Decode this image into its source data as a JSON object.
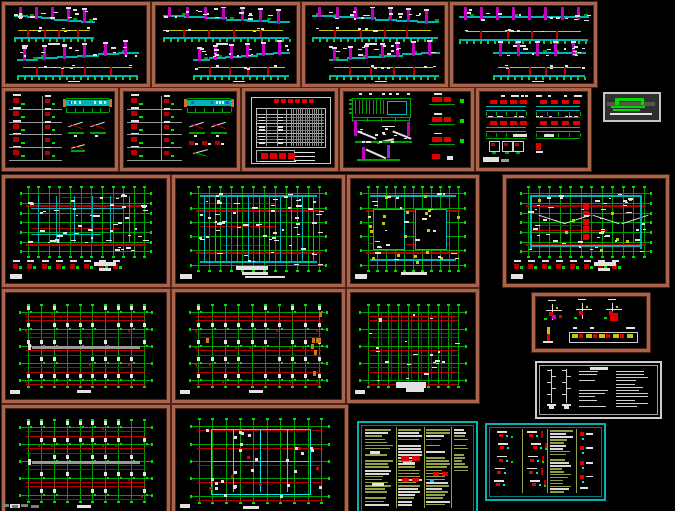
{
  "meta": {
    "title": "cad-structural-drawing-set-montage",
    "canvas": {
      "w": 675,
      "h": 511
    },
    "background": "#000000"
  },
  "palette": {
    "panelBrown": "#a8644c",
    "panelBrownDark": "#4e2416",
    "white": "#e2e2e2",
    "gray": "#9a9a9a",
    "darkGray": "#6f6f6f",
    "green": "#00a000",
    "brightGreen": "#00e000",
    "cyan": "#00b4b4",
    "brightCyan": "#00e8e8",
    "magenta": "#c400c4",
    "purple": "#8a2be2",
    "red": "#b40000",
    "brightRed": "#e00000",
    "yellow": "#c8c800",
    "orange": "#c87820",
    "olive": "#93a048",
    "blue": "#2a4bdd",
    "logoGreen": "#00d800"
  },
  "panels": [
    {
      "name": "sheet-longitudinal-section-1",
      "kind": "elevationPair",
      "x": 2,
      "y": 2,
      "w": 148,
      "h": 85,
      "border": "brown",
      "seed": 11,
      "opts": {
        "bands": [
          {
            "x0": 0.05,
            "x1": 0.63,
            "gy": 0.4,
            "slope": -1,
            "cols": 5
          },
          {
            "x0": 0.07,
            "x1": 0.95,
            "gy": 0.9,
            "slope": 1,
            "cols": 6
          }
        ]
      }
    },
    {
      "name": "sheet-longitudinal-section-2",
      "kind": "elevationPair",
      "x": 152,
      "y": 2,
      "w": 148,
      "h": 85,
      "border": "brown",
      "seed": 12,
      "opts": {
        "bands": [
          {
            "x0": 0.04,
            "x1": 0.96,
            "gy": 0.4,
            "slope": -1,
            "cols": 7
          },
          {
            "x0": 0.26,
            "x1": 0.96,
            "gy": 0.9,
            "slope": 1,
            "cols": 6
          }
        ]
      }
    },
    {
      "name": "sheet-longitudinal-section-3",
      "kind": "elevationPair",
      "x": 302,
      "y": 2,
      "w": 146,
      "h": 85,
      "border": "brown",
      "seed": 13,
      "opts": {
        "bands": [
          {
            "x0": 0.04,
            "x1": 0.96,
            "gy": 0.4,
            "slope": -1,
            "cols": 7
          },
          {
            "x0": 0.16,
            "x1": 0.97,
            "gy": 0.9,
            "slope": 1,
            "cols": 7
          }
        ]
      }
    },
    {
      "name": "sheet-longitudinal-section-4",
      "kind": "elevationPair",
      "x": 450,
      "y": 2,
      "w": 147,
      "h": 85,
      "border": "brown",
      "seed": 14,
      "opts": {
        "bands": [
          {
            "x0": 0.03,
            "x1": 0.97,
            "gy": 0.42,
            "slope": 0,
            "cols": 8
          },
          {
            "x0": 0.28,
            "x1": 0.95,
            "gy": 0.9,
            "slope": 0,
            "cols": 5
          }
        ]
      }
    },
    {
      "name": "sheet-beam-details-1",
      "kind": "detailGrid",
      "x": 2,
      "y": 88,
      "w": 116,
      "h": 83,
      "border": "brown",
      "seed": 21,
      "opts": {}
    },
    {
      "name": "sheet-beam-details-2",
      "kind": "detailGrid",
      "x": 120,
      "y": 88,
      "w": 120,
      "h": 83,
      "border": "brown",
      "seed": 22,
      "opts": {
        "variant": 2
      }
    },
    {
      "name": "sheet-schedule-table",
      "kind": "tableSheet",
      "x": 242,
      "y": 88,
      "w": 96,
      "h": 83,
      "border": "brown",
      "seed": 23,
      "opts": {}
    },
    {
      "name": "sheet-stair-details",
      "kind": "stairSheet",
      "x": 340,
      "y": 88,
      "w": 134,
      "h": 83,
      "border": "brown",
      "seed": 24,
      "opts": {}
    },
    {
      "name": "sheet-section-details",
      "kind": "detailSheet2",
      "x": 476,
      "y": 88,
      "w": 115,
      "h": 83,
      "border": "brown",
      "seed": 25,
      "opts": {}
    },
    {
      "name": "logo-mark",
      "kind": "logo",
      "x": 603,
      "y": 92,
      "w": 58,
      "h": 30,
      "border": "logo",
      "seed": 26,
      "opts": {}
    },
    {
      "name": "sheet-floor-framing-plan-1",
      "kind": "floorPlan",
      "x": 2,
      "y": 175,
      "w": 168,
      "h": 112,
      "border": "brown",
      "seed": 31,
      "opts": {
        "cyan": "mixed",
        "bottomRow": true,
        "nv": 12,
        "nh": 7,
        "specks": 50
      }
    },
    {
      "name": "sheet-floor-framing-plan-2",
      "kind": "floorPlan",
      "x": 172,
      "y": 175,
      "w": 173,
      "h": 112,
      "border": "brown",
      "seed": 32,
      "opts": {
        "cyanDense": true,
        "titleSmudge": "big",
        "nv": 12,
        "nh": 6,
        "specks": 60
      }
    },
    {
      "name": "sheet-roof-plan",
      "kind": "floorPlan",
      "x": 347,
      "y": 175,
      "w": 132,
      "h": 112,
      "border": "brown",
      "seed": 33,
      "opts": {
        "openings": true,
        "yellow": 18,
        "titleSmudge": true,
        "nv": 11,
        "nh": 6,
        "specks": 25
      }
    },
    {
      "name": "sheet-roof-framing-plan",
      "kind": "floorPlan",
      "x": 503,
      "y": 175,
      "w": 166,
      "h": 112,
      "border": "brown",
      "seed": 34,
      "opts": {
        "diagonals": true,
        "yellow": 8,
        "bottomRow": true,
        "nv": 12,
        "nh": 7,
        "specks": 45
      }
    },
    {
      "name": "sheet-column-plan-1",
      "kind": "columnPlan",
      "x": 2,
      "y": 289,
      "w": 168,
      "h": 114,
      "border": "brown",
      "seed": 41,
      "opts": {
        "grayBar": true
      }
    },
    {
      "name": "sheet-column-plan-2",
      "kind": "columnPlan",
      "x": 172,
      "y": 289,
      "w": 173,
      "h": 114,
      "border": "brown",
      "seed": 42,
      "opts": {
        "orange": true
      }
    },
    {
      "name": "sheet-foundation-plan",
      "kind": "foundationPlan",
      "x": 347,
      "y": 289,
      "w": 132,
      "h": 114,
      "border": "brown",
      "seed": 43,
      "opts": {}
    },
    {
      "name": "sheet-column-reinf-details",
      "kind": "smallDetailPanel",
      "x": 532,
      "y": 293,
      "w": 118,
      "h": 59,
      "border": "brown",
      "seed": 44,
      "opts": {}
    },
    {
      "name": "sheet-general-notes-1",
      "kind": "notesWhite",
      "x": 535,
      "y": 361,
      "w": 127,
      "h": 58,
      "border": "white",
      "seed": 45,
      "opts": {}
    },
    {
      "name": "sheet-column-plan-3",
      "kind": "columnPlan",
      "x": 2,
      "y": 405,
      "w": 168,
      "h": 112,
      "border": "brown",
      "seed": 51,
      "opts": {
        "grayBar": true
      }
    },
    {
      "name": "sheet-braced-framing-plan",
      "kind": "bracedPlan",
      "x": 172,
      "y": 405,
      "w": 176,
      "h": 112,
      "border": "brown",
      "seed": 52,
      "opts": {}
    },
    {
      "name": "sheet-general-notes-2",
      "kind": "notesCyan",
      "x": 357,
      "y": 421,
      "w": 121,
      "h": 95,
      "border": "cyan",
      "seed": 53,
      "opts": {}
    },
    {
      "name": "sheet-misc-details-notes",
      "kind": "detailsCyan",
      "x": 485,
      "y": 423,
      "w": 121,
      "h": 78,
      "border": "cyan",
      "seed": 54,
      "opts": {}
    }
  ],
  "watermark": {
    "x": 2,
    "y": 504,
    "w": 40,
    "h": 7
  }
}
